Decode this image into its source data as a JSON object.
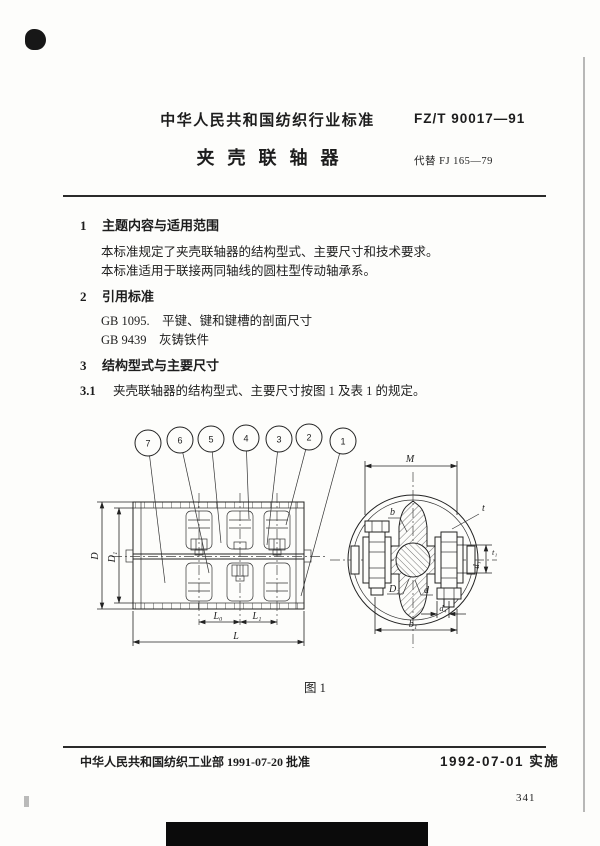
{
  "header": {
    "org": "中华人民共和国纺织行业标准",
    "code": "FZ/T 90017—91",
    "title": "夹壳联轴器",
    "replaces": "代替 FJ 165—79"
  },
  "sections": {
    "s1_num": "1",
    "s1_title": "主题内容与适用范围",
    "s1_p1": "本标准规定了夹壳联轴器的结构型式、主要尺寸和技术要求。",
    "s1_p2": "本标准适用于联接两同轴线的圆柱型传动轴承系。",
    "s2_num": "2",
    "s2_title": "引用标准",
    "s2_ref1": "GB 1095.　平键、键和键槽的剖面尺寸",
    "s2_ref2": "GB 9439　灰铸铁件",
    "s3_num": "3",
    "s3_title": "结构型式与主要尺寸",
    "s31_num": "3.1",
    "s31_text": "夹壳联轴器的结构型式、主要尺寸按图 1 及表 1 的规定。"
  },
  "figure": {
    "caption": "图 1",
    "callouts": [
      "7",
      "6",
      "5",
      "4",
      "3",
      "2",
      "1"
    ],
    "dims": {
      "D": "D",
      "D1": "D₁",
      "L0": "L₀",
      "L1": "L₁",
      "L": "L",
      "M": "M",
      "t": "t",
      "t1": "t₁",
      "d1": "d₁",
      "b": "b",
      "D2": "D₂",
      "d": "d",
      "d4": "d₄",
      "b1": "b₁"
    }
  },
  "footer": {
    "approved": "中华人民共和国纺织工业部 1991-07-20 批准",
    "implemented": "1992-07-01 实施",
    "page_number": "341"
  }
}
